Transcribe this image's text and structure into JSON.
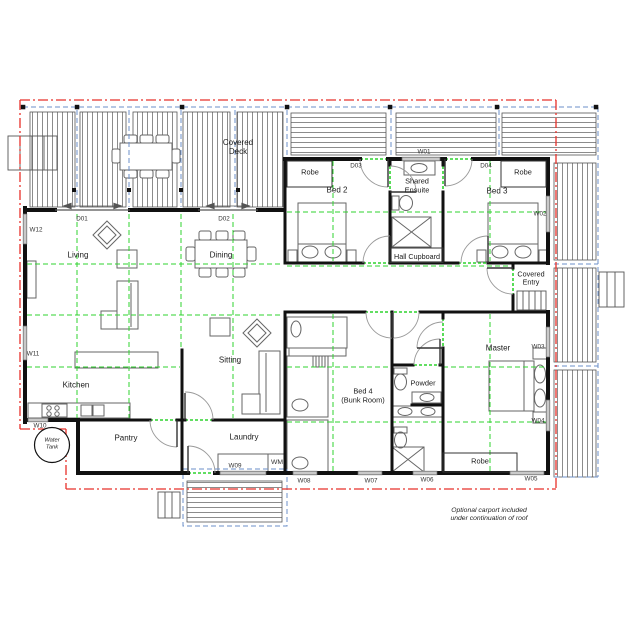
{
  "plan": {
    "rooms": {
      "covered_deck": "Covered\nDeck",
      "living": "Living",
      "dining": "Dining",
      "kitchen": "Kitchen",
      "sitting": "Sitting",
      "pantry": "Pantry",
      "laundry": "Laundry",
      "bed2": "Bed 2",
      "bed3": "Bed 3",
      "bed4": "Bed 4\n(Bunk Room)",
      "master": "Master",
      "shared_ensuite": "Shared\nEnsuite",
      "powder": "Powder",
      "hall_cupboard": "Hall Cupboard",
      "covered_entry": "Covered\nEntry",
      "robe_bed2": "Robe",
      "robe_bed3": "Robe",
      "robe_master": "Robe",
      "wm": "WM",
      "water_tank": "Water\nTank"
    },
    "doors": {
      "d01": "D01",
      "d02": "D02",
      "d03": "D03",
      "d04": "D04"
    },
    "windows": {
      "w01": "W01",
      "w02": "W02",
      "w03": "W03",
      "w04": "W04",
      "w05": "W05",
      "w06": "W06",
      "w07": "W07",
      "w08": "W08",
      "w09": "W09",
      "w10": "W10",
      "w11": "W11",
      "w12": "W12"
    },
    "note": "Optional carport included\nunder continuation of roof",
    "colors": {
      "roof_line": "#e8312a",
      "eaves_line": "#6b8fc9",
      "module_line": "#2fd32f",
      "wall": "#111111"
    }
  }
}
